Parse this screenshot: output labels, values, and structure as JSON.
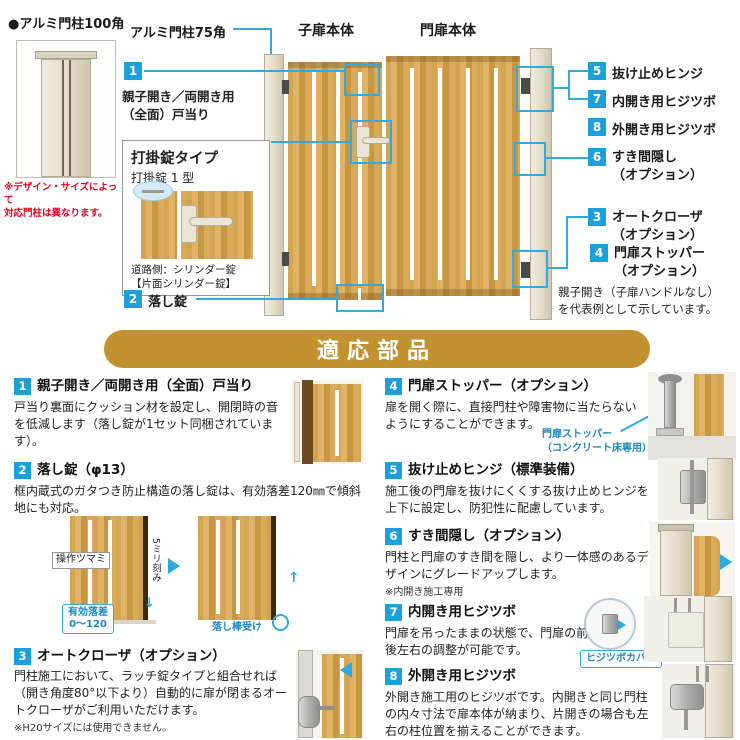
{
  "palette": {
    "badge_blue": "#1c9fdb",
    "callout_blue": "#33a9dc",
    "banner_gold": "#c29130",
    "red_note": "#e50020",
    "wood_tan": "#d3a452",
    "post_cream": "#e4ddcb"
  },
  "top": {
    "post100_label": "●アルミ門柱100角",
    "post100_note": "※デザイン・サイズによって\n対応門柱は異なります。",
    "post75_label": "アルミ門柱75角",
    "child_door_label": "子扉本体",
    "main_door_label": "門扉本体",
    "callout1": {
      "num": "1",
      "label": "親子開き／両開き用\n（全面）戸当り"
    },
    "callout2": {
      "num": "2",
      "label": "落し錠"
    },
    "lock_box": {
      "title": "打掛錠タイプ",
      "model": "打掛錠 1 型",
      "caption": "道路側：シリンダー錠\n【片面シリンダー錠】"
    },
    "right_callouts": [
      {
        "num": "5",
        "label": "抜け止めヒンジ"
      },
      {
        "num": "7",
        "label": "内開き用ヒジツボ"
      },
      {
        "num": "8",
        "label": "外開き用ヒジツボ"
      },
      {
        "num": "6",
        "label": "すき間隠し\n（オプション）"
      },
      {
        "num": "3",
        "label": "オートクローザ\n（オプション）"
      },
      {
        "num": "4",
        "label": "門扉ストッパー\n（オプション）"
      }
    ],
    "representative_note": "親子開き（子扉ハンドルなし）\nを代表例として示しています。"
  },
  "banner": {
    "title": "適応部品"
  },
  "sections": [
    {
      "num": "1",
      "title": "親子開き／両開き用（全面）戸当り",
      "body": "戸当り裏面にクッション材を設定し、開閉時の音を低減します（落し錠が1セット同梱されています）。"
    },
    {
      "num": "2",
      "title": "落し錠（φ13）",
      "body": "框内蔵式のガタつき防止構造の落し錠は、有効落差120㎜で傾斜地にも対応。",
      "labels": {
        "knob": "操作ツマミ",
        "pitch": "5ミリ刻み",
        "drop": "有効落差\n0〜120",
        "receiver": "落し棒受け"
      }
    },
    {
      "num": "3",
      "title": "オートクローザ（オプション）",
      "body": "門柱施工において、ラッチ錠タイプと組合せれば（開き角度80°以下より）自動的に扉が閉まるオートクローザがご利用いただけます。",
      "note": "※H20サイズには使用できません。"
    },
    {
      "num": "4",
      "title": "門扉ストッパー（オプション）",
      "body": "扉を開く際に、直接門柱や障害物に当たらないようにすることができます。",
      "img_label": "門扉ストッパー\n（コンクリート床専用）"
    },
    {
      "num": "5",
      "title": "抜け止めヒンジ（標準装備）",
      "body": "施工後の門扉を抜けにくくする抜け止めヒンジを上下に設定し、防犯性に配慮しています。"
    },
    {
      "num": "6",
      "title": "すき間隠し（オプション）",
      "body": "門柱と門扉のすき間を隠し、より一体感のあるデザインにグレードアップします。",
      "note": "※内開き施工専用"
    },
    {
      "num": "7",
      "title": "内開き用ヒジツボ",
      "body": "門扉を吊ったままの状態で、門扉の前後左右の調整が可能です。",
      "img_label": "ヒジツボカバー"
    },
    {
      "num": "8",
      "title": "外開き用ヒジツボ",
      "body": "外開き施工用のヒジツボです。内開きと同じ門柱の内々寸法で扉本体が納まり、片開きの場合も左右の柱位置を揃えることができます。"
    }
  ]
}
